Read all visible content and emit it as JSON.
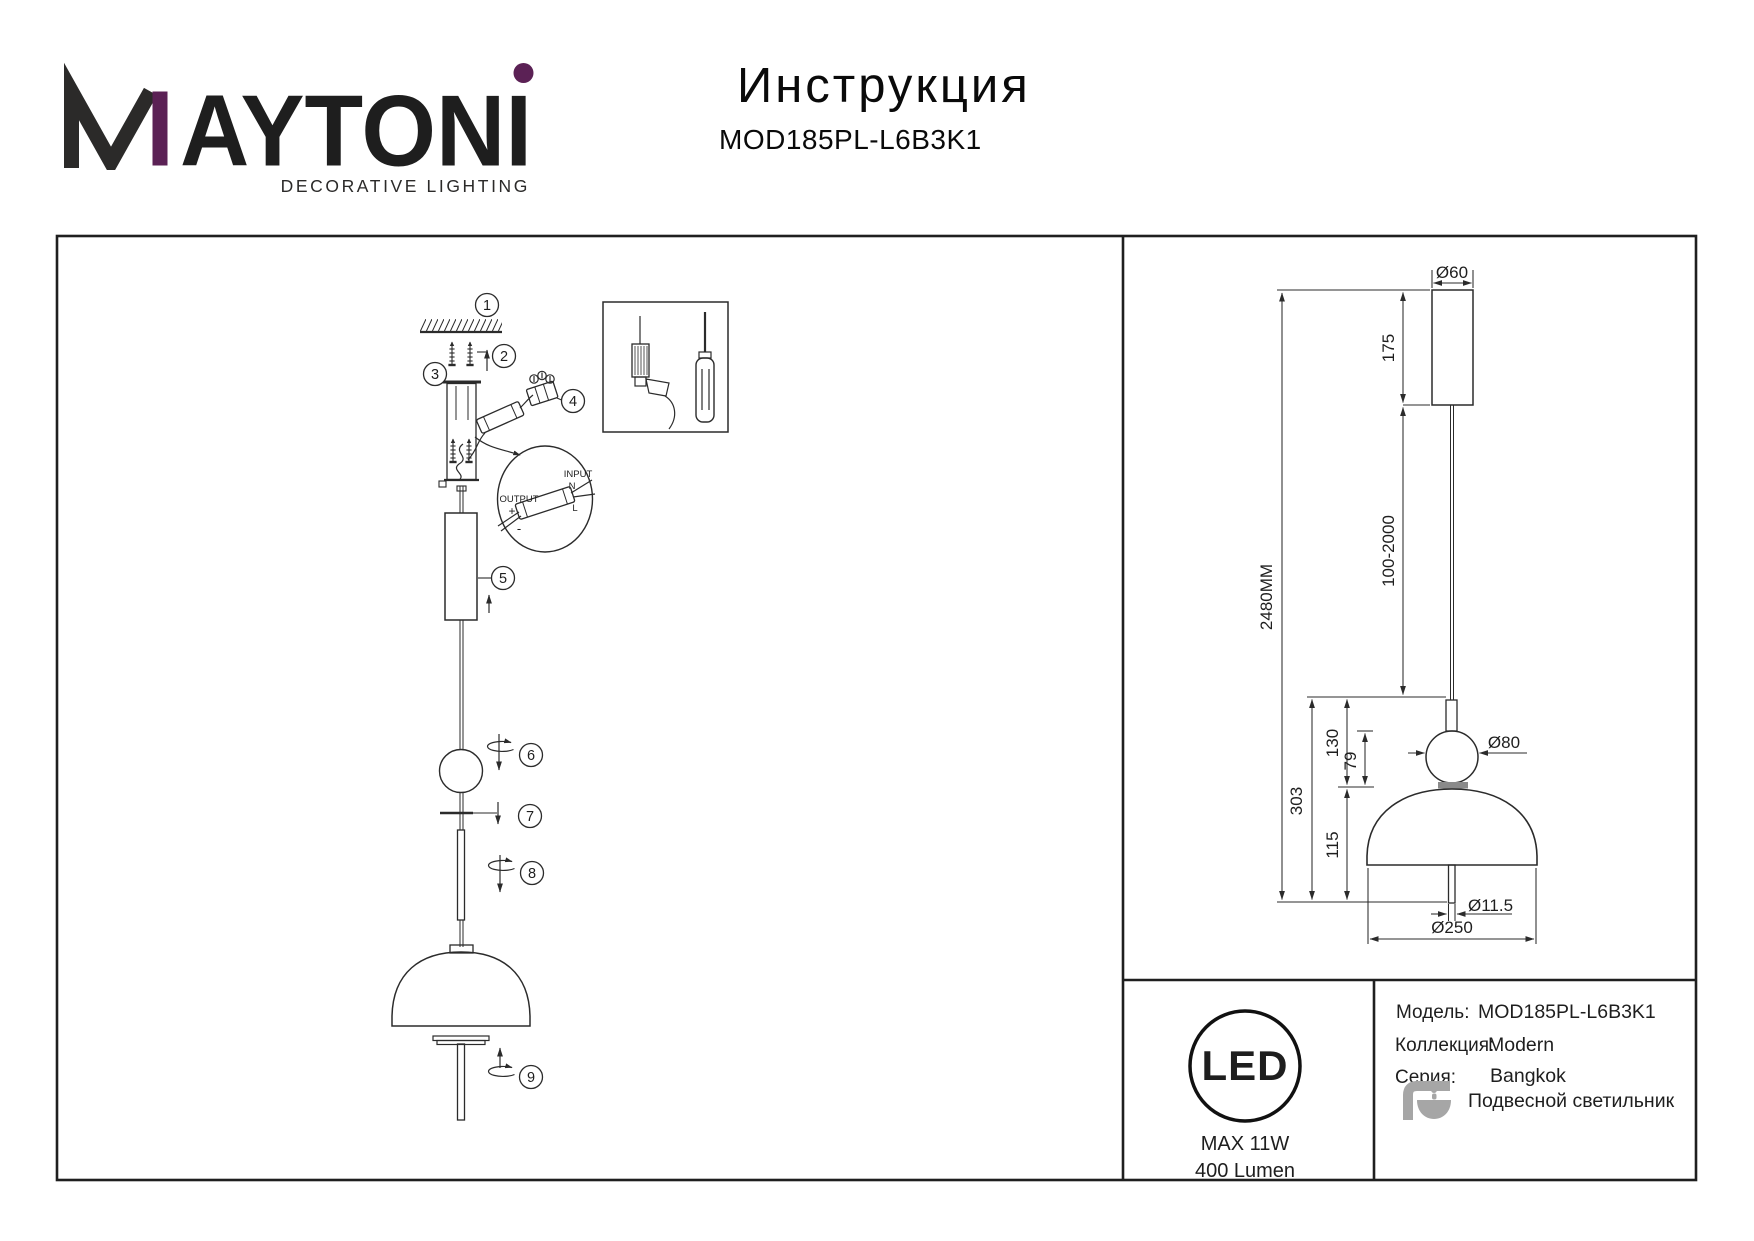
{
  "brand": {
    "name": "MAYTONI",
    "name_rest": "AYTONI",
    "tagline": "DECORATIVE LIGHTING",
    "purple": "#5B2155",
    "ink": "#2B2A29"
  },
  "header": {
    "title": "Инструкция",
    "model": "MOD185PL-L6B3K1"
  },
  "assembly": {
    "steps": [
      "1",
      "2",
      "3",
      "4",
      "5",
      "6",
      "7",
      "8",
      "9"
    ],
    "wiring_detail": {
      "output_label": "OUTPUT",
      "output_plus": "+",
      "output_minus": "-",
      "input_label": "INPUT",
      "input_n": "N",
      "input_l": "L"
    }
  },
  "dimension_drawing": {
    "overall_height": "2480MM",
    "canopy_diameter": "Ø60",
    "canopy_height": "175",
    "cable_length": "100-2000",
    "fixture_height": "303",
    "upper_section_height": "130",
    "sphere_height": "79",
    "shade_height": "115",
    "sphere_diameter": "Ø80",
    "stem_diameter": "Ø11.5",
    "shade_diameter": "Ø250"
  },
  "badge": {
    "text": "LED",
    "power": "MAX 11W",
    "luminous_flux": "400 Lumen"
  },
  "product_info": {
    "rows": [
      {
        "label": "Модель:",
        "value": "MOD185PL-L6B3K1"
      },
      {
        "label": "Коллекция:",
        "value": "Modern"
      },
      {
        "label": "Серия:",
        "value": "Bangkok"
      },
      {
        "label": "",
        "value": "Подвесной светильник"
      }
    ]
  },
  "colors": {
    "line": "#2B2B2B",
    "icon_gray": "#A6A6A6"
  }
}
